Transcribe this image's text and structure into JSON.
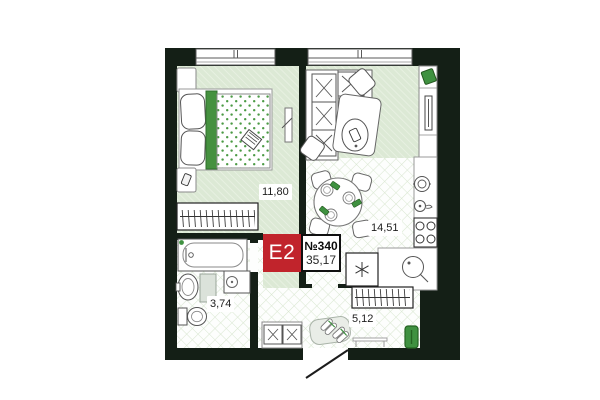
{
  "badge": {
    "type": "E2",
    "number": "№340",
    "total_area": "35,17"
  },
  "rooms": [
    {
      "name": "bedroom",
      "area": "11,80"
    },
    {
      "name": "kitchen-living-room",
      "area": "14,51"
    },
    {
      "name": "bathroom",
      "area": "3,74"
    },
    {
      "name": "hallway",
      "area": "5,12"
    }
  ],
  "colors": {
    "wall": "#141f16",
    "floor_green": "#dce9d5",
    "floor_hatch_line": "#eaf2e4",
    "lattice_line": "#d9e7d1",
    "accent_green": "#3f9140",
    "accent_green_dark": "#276426",
    "badge_red": "#c1242c",
    "outline_gray": "#777777"
  }
}
